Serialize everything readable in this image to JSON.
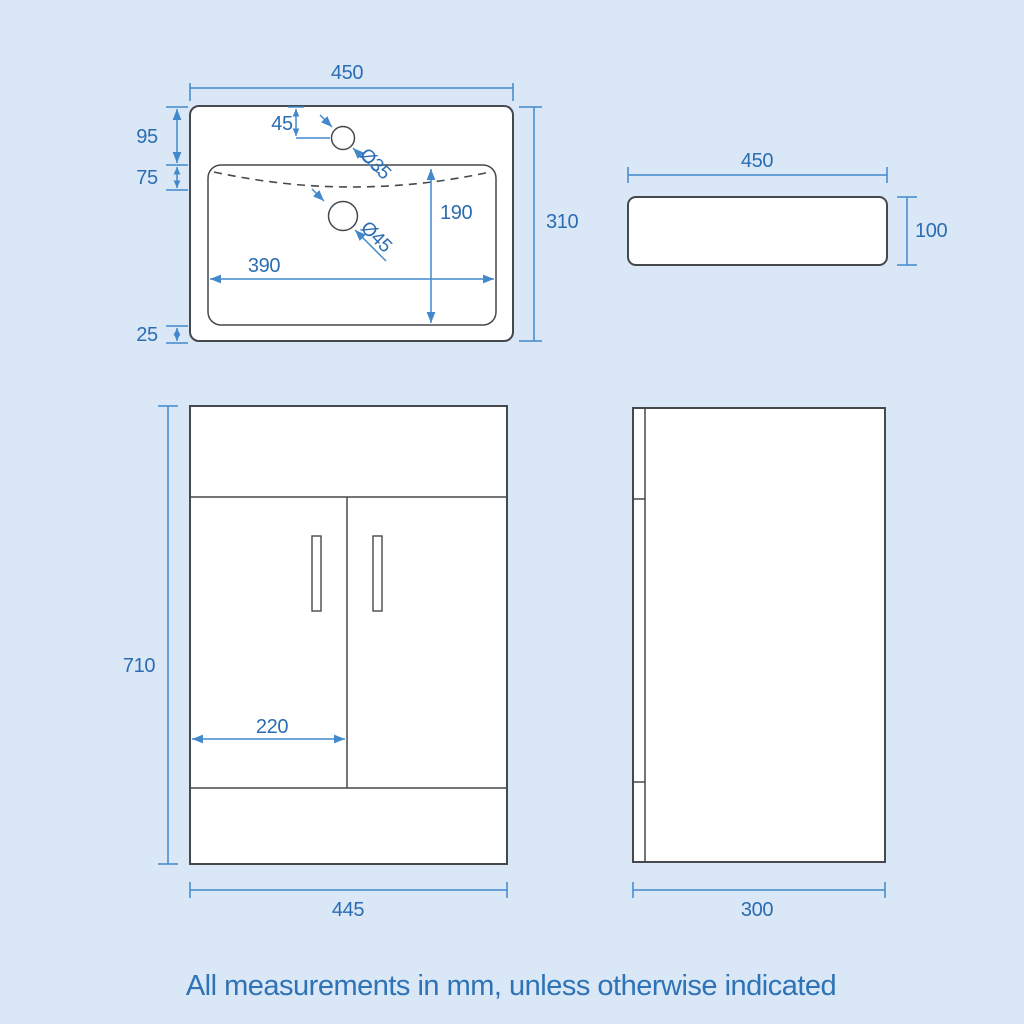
{
  "colors": {
    "background": "#d9e7f6",
    "outline": "#45494d",
    "dimension_line": "#4189cb",
    "dimension_text": "#2b6db2",
    "footer_text": "#2e73b6",
    "shape_fill": "#ffffff"
  },
  "views": {
    "sink_top": {
      "overall_width": "450",
      "overall_depth": "310",
      "rim_to_basin": "95",
      "overflow_depth": "75",
      "basin_to_front": "25",
      "tap_hole_offset": "45",
      "tap_hole_diameter": "Ø35",
      "waste_hole_diameter": "Ø45",
      "basin_depth": "190",
      "basin_width": "390"
    },
    "sink_side": {
      "width": "450",
      "height": "100"
    },
    "cabinet_front": {
      "height": "710",
      "door_width": "220",
      "width": "445"
    },
    "cabinet_side": {
      "depth": "300"
    }
  },
  "footer": {
    "note": "All measurements in mm, unless otherwise indicated"
  }
}
